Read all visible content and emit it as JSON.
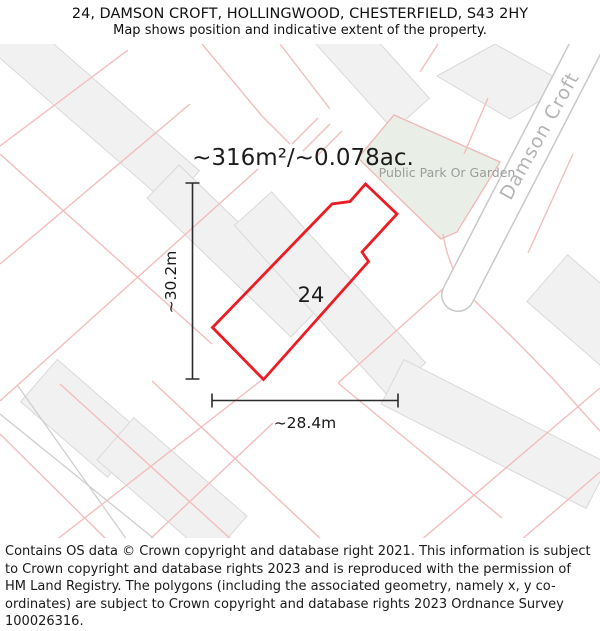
{
  "header": {
    "title": "24, DAMSON CROFT, HOLLINGWOOD, CHESTERFIELD, S43 2HY",
    "subtitle": "Map shows position and indicative extent of the property."
  },
  "map": {
    "area_label": "~316m²/~0.078ac.",
    "plot_number": "24",
    "park_label": "Public Park Or Garden",
    "road_label": "Damson Croft",
    "dimensions": {
      "height": "~30.2m",
      "width": "~28.4m"
    },
    "colors": {
      "plot_outline": "#ed1c24",
      "park_fill": "#e9efe7",
      "parcel_line": "#f3bdbd",
      "building_fill": "#f1f1f1",
      "building_stroke": "#d9d9d9",
      "road_edge": "#c9c9c9",
      "road_label": "#b4b4b4",
      "park_label": "#9c9c9c",
      "dimension_line": "#2b2b2b"
    }
  },
  "footer": {
    "text": "Contains OS data © Crown copyright and database right 2021. This information is subject to Crown copyright and database rights 2023 and is reproduced with the permission of HM Land Registry. The polygons (including the associated geometry, namely x, y co-ordinates) are subject to Crown copyright and database rights 2023 Ordnance Survey 100026316."
  }
}
